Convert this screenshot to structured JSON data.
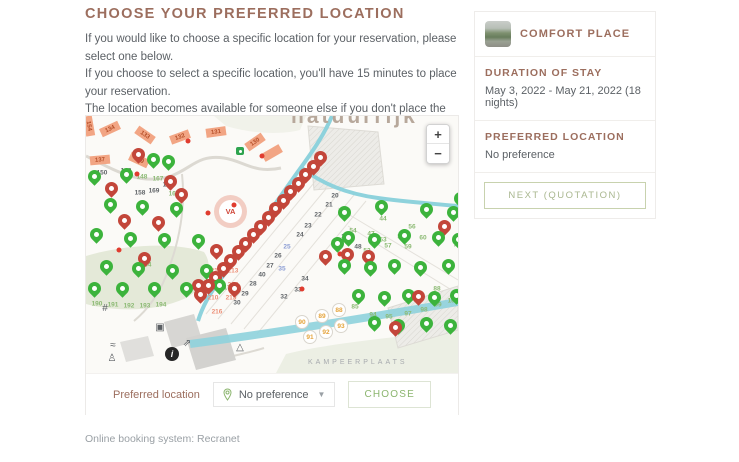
{
  "page": {
    "heading": "CHOOSE YOUR PREFERRED LOCATION",
    "paragraph_lines": [
      "If you would like to choose a specific location for your reservation, please select one below.",
      "If you choose to select a specific location, you'll have 15 minutes to place your reservation.",
      "The location becomes available for someone else if you don't place the reservation within",
      "15 minutes."
    ],
    "footer": "Online booking system: Recranet"
  },
  "controls": {
    "preferred_label": "Preferred location",
    "dropdown_value": "No preference",
    "choose_label": "CHOOSE"
  },
  "sidebar": {
    "title": "COMFORT PLACE",
    "duration_title": "DURATION OF STAY",
    "duration_value": "May 3, 2022 - May 21, 2022 (18 nights)",
    "preferred_title": "PREFERRED LOCATION",
    "preferred_value": "No preference",
    "next_label": "NEXT (QUOTATION)"
  },
  "map": {
    "watermark": "natuurrijk",
    "area_label": "KAMPEERPLAATS",
    "zoom_in": "+",
    "zoom_out": "−",
    "logo_text": "VA",
    "colors": {
      "pin_green": "#3cb33c",
      "pin_red": "#c3463a",
      "canal": "#8ed2dc",
      "building": "#f2a584"
    },
    "pins": {
      "green": [
        [
          67,
          53
        ],
        [
          82,
          55
        ],
        [
          8,
          70
        ],
        [
          40,
          68
        ],
        [
          24,
          98
        ],
        [
          56,
          100
        ],
        [
          90,
          102
        ],
        [
          10,
          128
        ],
        [
          44,
          132
        ],
        [
          78,
          133
        ],
        [
          112,
          134
        ],
        [
          20,
          160
        ],
        [
          52,
          162
        ],
        [
          86,
          164
        ],
        [
          120,
          164
        ],
        [
          36,
          182
        ],
        [
          68,
          182
        ],
        [
          100,
          182
        ],
        [
          133,
          179
        ],
        [
          8,
          182
        ],
        [
          251,
          137
        ],
        [
          258,
          106
        ],
        [
          295,
          100
        ],
        [
          340,
          103
        ],
        [
          367,
          106
        ],
        [
          262,
          131
        ],
        [
          288,
          133
        ],
        [
          318,
          129
        ],
        [
          352,
          131
        ],
        [
          372,
          133
        ],
        [
          258,
          159
        ],
        [
          284,
          161
        ],
        [
          308,
          159
        ],
        [
          334,
          161
        ],
        [
          362,
          159
        ],
        [
          272,
          189
        ],
        [
          298,
          191
        ],
        [
          322,
          189
        ],
        [
          348,
          191
        ],
        [
          370,
          189
        ],
        [
          288,
          216
        ],
        [
          312,
          219
        ],
        [
          340,
          217
        ],
        [
          364,
          219
        ],
        [
          374,
          92
        ]
      ],
      "red": [
        [
          52,
          48
        ],
        [
          84,
          75
        ],
        [
          25,
          82
        ],
        [
          95,
          88
        ],
        [
          38,
          114
        ],
        [
          72,
          116
        ],
        [
          130,
          144
        ],
        [
          58,
          152
        ],
        [
          112,
          179
        ],
        [
          148,
          182
        ],
        [
          239,
          150
        ],
        [
          261,
          148
        ],
        [
          358,
          120
        ],
        [
          282,
          150
        ],
        [
          332,
          190
        ],
        [
          309,
          221
        ],
        [
          114,
          188
        ],
        [
          122,
          179
        ],
        [
          129,
          171
        ],
        [
          137,
          162
        ],
        [
          144,
          154
        ],
        [
          152,
          145
        ],
        [
          159,
          137
        ],
        [
          167,
          128
        ],
        [
          174,
          120
        ],
        [
          182,
          111
        ],
        [
          189,
          102
        ],
        [
          197,
          94
        ],
        [
          204,
          85
        ],
        [
          212,
          77
        ],
        [
          219,
          68
        ],
        [
          227,
          60
        ],
        [
          234,
          51
        ]
      ]
    },
    "buildings": [
      {
        "t": "134",
        "x": 24,
        "y": 13,
        "r": -25
      },
      {
        "t": "133",
        "x": 59,
        "y": 19,
        "r": 35
      },
      {
        "t": "132",
        "x": 94,
        "y": 21,
        "r": -20
      },
      {
        "t": "131",
        "x": 130,
        "y": 16,
        "r": -8
      },
      {
        "t": "130",
        "x": 169,
        "y": 26,
        "r": -35
      },
      {
        "t": "137",
        "x": 14,
        "y": 44,
        "r": -5
      },
      {
        "t": "139",
        "x": 53,
        "y": 44,
        "r": 25
      },
      {
        "t": "",
        "x": 186,
        "y": 37,
        "r": -30
      },
      {
        "t": "154",
        "x": 3,
        "y": 10,
        "r": 80
      }
    ],
    "labels": [
      {
        "t": "150",
        "x": 16,
        "y": 57,
        "c": "dark"
      },
      {
        "t": "148",
        "x": 40,
        "y": 55,
        "c": "dark"
      },
      {
        "t": "158",
        "x": 54,
        "y": 77,
        "c": "dark"
      },
      {
        "t": "169",
        "x": 68,
        "y": 75,
        "c": "dark"
      },
      {
        "t": "160",
        "x": 82,
        "y": 69,
        "c": "dark"
      },
      {
        "t": "20",
        "x": 249,
        "y": 80,
        "c": "dark"
      },
      {
        "t": "21",
        "x": 243,
        "y": 89,
        "c": "dark"
      },
      {
        "t": "22",
        "x": 232,
        "y": 99,
        "c": "dark"
      },
      {
        "t": "23",
        "x": 222,
        "y": 110,
        "c": "dark"
      },
      {
        "t": "24",
        "x": 214,
        "y": 119,
        "c": "dark"
      },
      {
        "t": "25",
        "x": 201,
        "y": 131,
        "c": "blue"
      },
      {
        "t": "26",
        "x": 192,
        "y": 140,
        "c": "dark"
      },
      {
        "t": "27",
        "x": 184,
        "y": 150,
        "c": "dark"
      },
      {
        "t": "40",
        "x": 176,
        "y": 159,
        "c": "dark"
      },
      {
        "t": "28",
        "x": 167,
        "y": 168,
        "c": "dark"
      },
      {
        "t": "29",
        "x": 159,
        "y": 178,
        "c": "dark"
      },
      {
        "t": "30",
        "x": 151,
        "y": 187,
        "c": "dark"
      },
      {
        "t": "32",
        "x": 198,
        "y": 181,
        "c": "dark"
      },
      {
        "t": "33",
        "x": 212,
        "y": 174,
        "c": "dark"
      },
      {
        "t": "34",
        "x": 219,
        "y": 163,
        "c": "dark"
      },
      {
        "t": "35",
        "x": 196,
        "y": 153,
        "c": "blue"
      },
      {
        "t": "36",
        "x": 241,
        "y": 140,
        "c": "dark"
      },
      {
        "t": "38",
        "x": 259,
        "y": 121,
        "c": "dark"
      },
      {
        "t": "48",
        "x": 272,
        "y": 131,
        "c": "dark"
      },
      {
        "t": "148",
        "x": 56,
        "y": 61,
        "c": "green"
      },
      {
        "t": "167",
        "x": 72,
        "y": 63,
        "c": "green"
      },
      {
        "t": "163",
        "x": 88,
        "y": 78,
        "c": "green"
      },
      {
        "t": "184",
        "x": 60,
        "y": 149,
        "c": "green"
      },
      {
        "t": "176",
        "x": 143,
        "y": 172,
        "c": "green"
      },
      {
        "t": "190",
        "x": 11,
        "y": 188,
        "c": "green"
      },
      {
        "t": "191",
        "x": 27,
        "y": 189,
        "c": "green"
      },
      {
        "t": "192",
        "x": 43,
        "y": 190,
        "c": "green"
      },
      {
        "t": "193",
        "x": 59,
        "y": 190,
        "c": "green"
      },
      {
        "t": "194",
        "x": 75,
        "y": 189,
        "c": "green"
      },
      {
        "t": "44",
        "x": 297,
        "y": 103,
        "c": "green"
      },
      {
        "t": "54",
        "x": 267,
        "y": 115,
        "c": "green"
      },
      {
        "t": "56",
        "x": 326,
        "y": 111,
        "c": "green"
      },
      {
        "t": "47",
        "x": 285,
        "y": 118,
        "c": "green"
      },
      {
        "t": "53",
        "x": 297,
        "y": 124,
        "c": "green"
      },
      {
        "t": "58",
        "x": 315,
        "y": 121,
        "c": "green"
      },
      {
        "t": "57",
        "x": 302,
        "y": 130,
        "c": "green"
      },
      {
        "t": "52",
        "x": 281,
        "y": 135,
        "c": "green"
      },
      {
        "t": "59",
        "x": 322,
        "y": 131,
        "c": "green"
      },
      {
        "t": "60",
        "x": 337,
        "y": 122,
        "c": "green"
      },
      {
        "t": "73",
        "x": 371,
        "y": 129,
        "c": "green"
      },
      {
        "t": "85",
        "x": 269,
        "y": 191,
        "c": "green"
      },
      {
        "t": "88",
        "x": 351,
        "y": 173,
        "c": "green"
      },
      {
        "t": "94",
        "x": 287,
        "y": 199,
        "c": "green"
      },
      {
        "t": "95",
        "x": 303,
        "y": 201,
        "c": "green"
      },
      {
        "t": "97",
        "x": 322,
        "y": 198,
        "c": "green"
      },
      {
        "t": "98",
        "x": 338,
        "y": 194,
        "c": "green"
      },
      {
        "t": "99",
        "x": 352,
        "y": 189,
        "c": "green"
      },
      {
        "t": "100",
        "x": 367,
        "y": 185,
        "c": "green"
      },
      {
        "t": "212",
        "x": 130,
        "y": 155,
        "c": "red"
      },
      {
        "t": "213",
        "x": 147,
        "y": 155,
        "c": "red"
      },
      {
        "t": "211",
        "x": 129,
        "y": 169,
        "c": "red"
      },
      {
        "t": "214",
        "x": 147,
        "y": 169,
        "c": "red"
      },
      {
        "t": "210",
        "x": 127,
        "y": 182,
        "c": "red"
      },
      {
        "t": "215",
        "x": 145,
        "y": 182,
        "c": "red"
      },
      {
        "t": "216",
        "x": 131,
        "y": 196,
        "c": "red"
      }
    ],
    "circled": [
      {
        "t": "90",
        "x": 216,
        "y": 206
      },
      {
        "t": "89",
        "x": 236,
        "y": 200
      },
      {
        "t": "88",
        "x": 253,
        "y": 194
      },
      {
        "t": "91",
        "x": 224,
        "y": 221
      },
      {
        "t": "92",
        "x": 240,
        "y": 216
      },
      {
        "t": "93",
        "x": 255,
        "y": 210
      }
    ],
    "dots": [
      [
        102,
        25
      ],
      [
        51,
        58
      ],
      [
        254,
        138
      ],
      [
        216,
        173
      ],
      [
        33,
        134
      ],
      [
        148,
        89
      ],
      [
        176,
        40
      ],
      [
        122,
        97
      ]
    ],
    "poi": [
      {
        "n": "high-ropes-icon",
        "g": "#",
        "x": 19,
        "y": 193
      },
      {
        "n": "washing-machine-icon",
        "g": "▣",
        "x": 74,
        "y": 212
      },
      {
        "n": "paper-plane-icon",
        "g": "⇗",
        "x": 101,
        "y": 228
      },
      {
        "n": "waves-icon",
        "g": "≈",
        "x": 27,
        "y": 230
      },
      {
        "n": "person-icon",
        "g": "♙",
        "x": 26,
        "y": 243
      },
      {
        "n": "recycle-icon",
        "g": "△",
        "x": 154,
        "y": 232
      },
      {
        "n": "info-icon",
        "g": "i",
        "x": 86,
        "y": 238,
        "dark": true
      }
    ]
  }
}
